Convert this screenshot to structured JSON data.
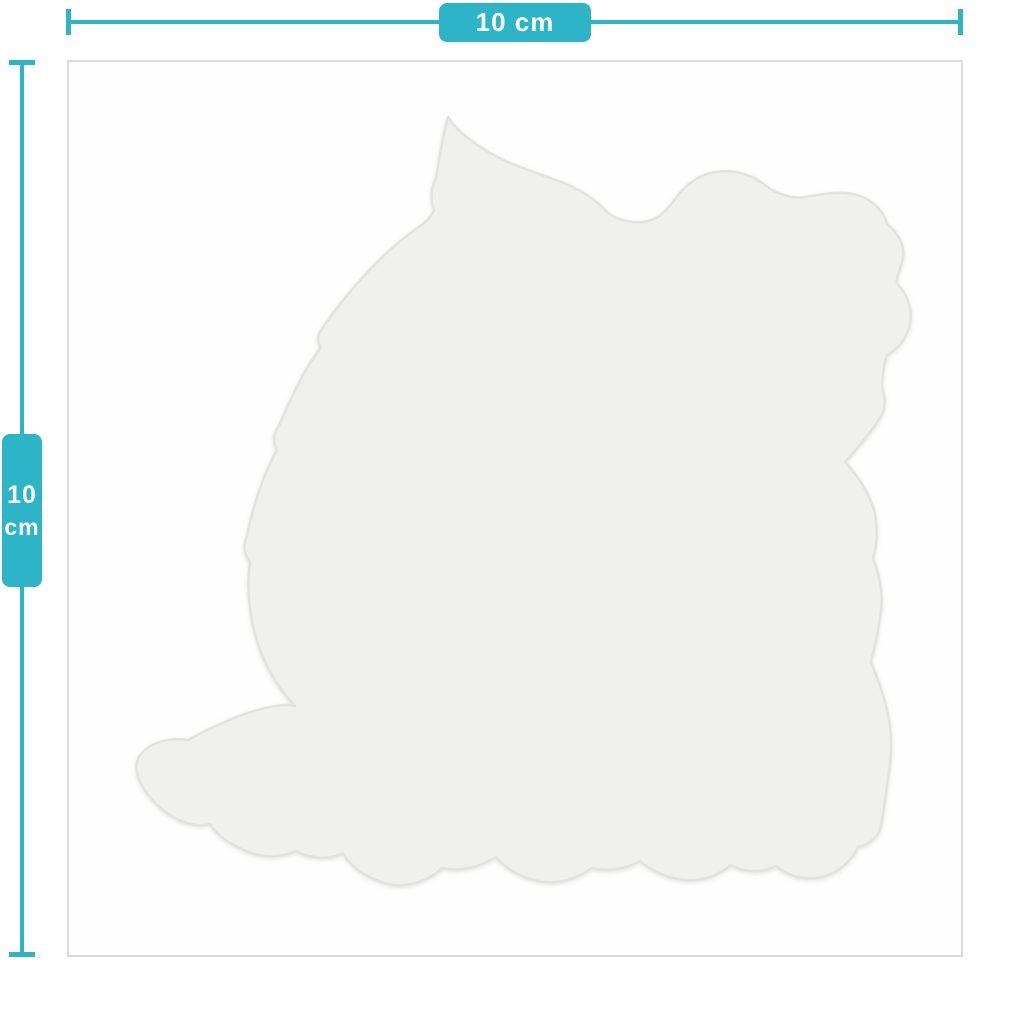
{
  "page": {
    "type": "product-dimension-mockup",
    "background_color": "#ffffff"
  },
  "colors": {
    "accent_teal": "#2db4c6",
    "label_text": "#ffffff",
    "sheet_fill": "#fefefe",
    "sheet_border": "#dadada",
    "sticker_fill": "#f0f0ee",
    "sticker_outline": "#e2e2df"
  },
  "product": {
    "sheet_name": "square-sticker-sheet",
    "sticker_shape_name": "dog-silhouette-die-cut-sticker"
  },
  "dimensions": {
    "width": {
      "label": "10 cm",
      "value": "10",
      "unit": "cm"
    },
    "height": {
      "value": "10",
      "unit": "cm"
    }
  }
}
